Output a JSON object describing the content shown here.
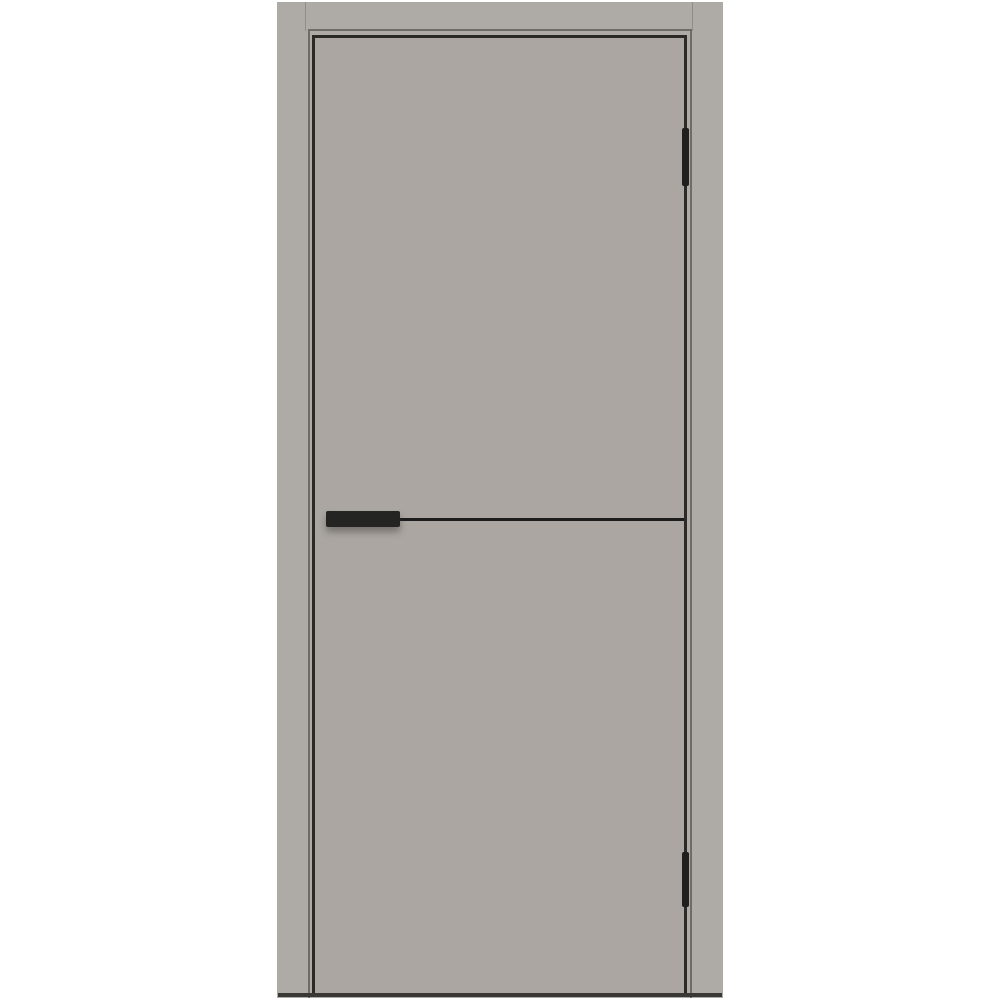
{
  "image": {
    "type": "product-photo",
    "subject": "Flush interior door with black hardware, front view",
    "background_color": "#ffffff"
  },
  "door": {
    "leaf_color": "#aba6a1",
    "frame_color": "#aeaaa5",
    "reveal_line_color": "#6f6b65",
    "gap_line_color": "#2b2a27",
    "molding_color": "#1c1c1c",
    "handle_color": "#242422",
    "hinge_color": "#201f1e",
    "hinge_count": 2,
    "floor_shadow_color": "#3a3834"
  }
}
